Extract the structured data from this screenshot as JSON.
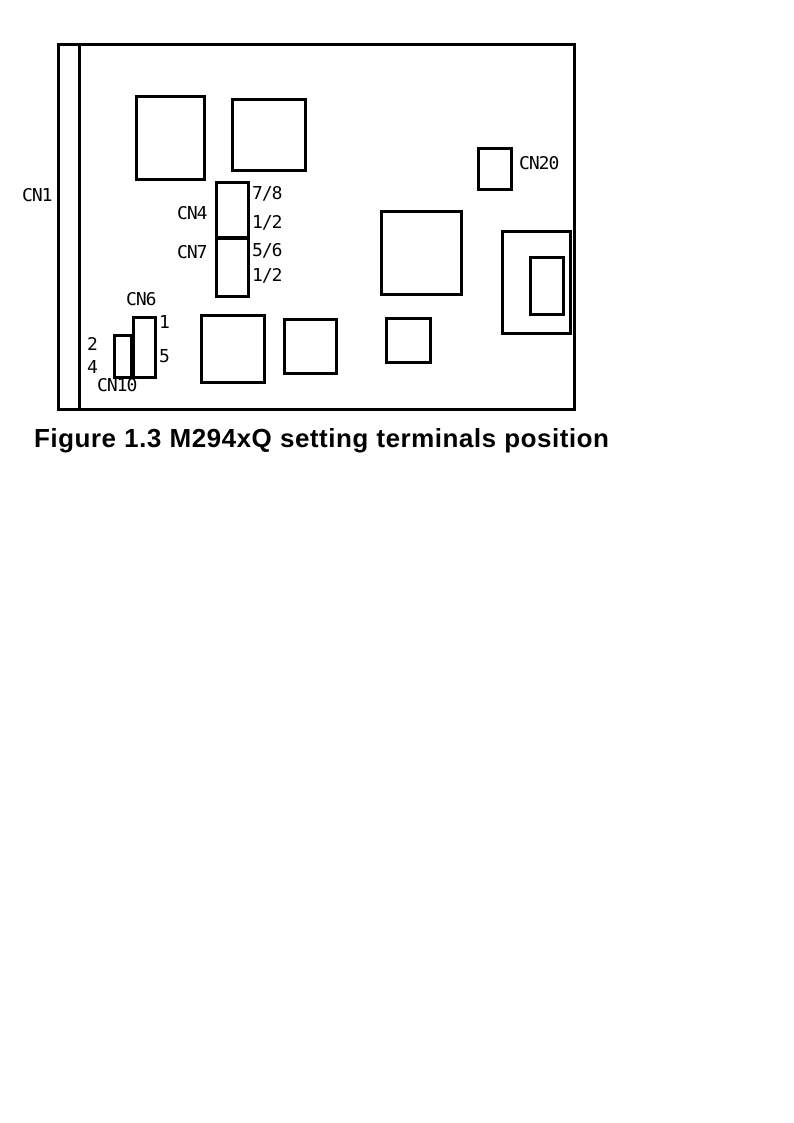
{
  "figure": {
    "caption": "Figure 1.3 M294xQ setting terminals position"
  },
  "connectors": {
    "cn1": {
      "label": "CN1"
    },
    "cn4": {
      "label": "CN4",
      "pin_top": "7/8",
      "pin_bottom": "1/2"
    },
    "cn7": {
      "label": "CN7",
      "pin_top": "5/6",
      "pin_bottom": "1/2"
    },
    "cn6": {
      "label": "CN6",
      "pin_top": "1",
      "pin_bottom": "5"
    },
    "cn10": {
      "label": "CN10",
      "pin_top": "2",
      "pin_bottom": "4"
    },
    "cn20": {
      "label": "CN20"
    }
  },
  "colors": {
    "line": "#000000",
    "background": "#ffffff"
  }
}
